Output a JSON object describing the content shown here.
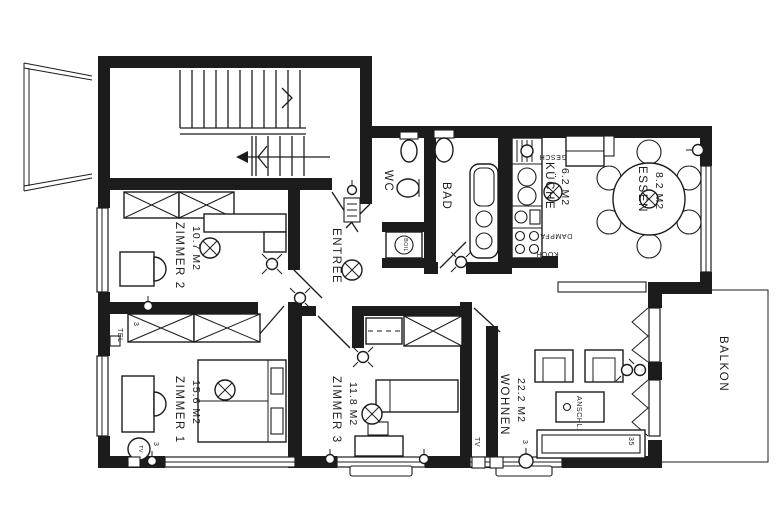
{
  "colors": {
    "ink": "#1c1c1c",
    "paper": "#ffffff"
  },
  "rooms": {
    "entree": {
      "name": "ENTREE"
    },
    "wc": {
      "name": "WC"
    },
    "bad": {
      "name": "BAD"
    },
    "kueche": {
      "name": "KÜCHE",
      "area": "6.2 M2"
    },
    "essen": {
      "name": "ESSEN",
      "area": "8.2 M2"
    },
    "wohnen": {
      "name": "WOHNEN",
      "area": "22.2 M2"
    },
    "balkon": {
      "name": "BALKON"
    },
    "zimmer1": {
      "name": "ZIMMER 1",
      "area": "15.6 M2"
    },
    "zimmer2": {
      "name": "ZIMMER 2",
      "area": "10.7 M2"
    },
    "zimmer3": {
      "name": "ZIMMER 3",
      "area": "11.8 M2"
    }
  },
  "annotations": {
    "boiler": "BOIL",
    "dishwasher": "GESCH",
    "steam_hood": "DAMPFA",
    "stove": "KOCH.",
    "connection": "ANSCHL.",
    "tv_living": "TV",
    "tel_living": "TEL",
    "tv_bedroom1": "TV",
    "tel_bedroom2": "TEL",
    "switch_living": "3",
    "switch_bedroom1": "3",
    "switch_bedroom2": "3",
    "mark_35": "35"
  }
}
